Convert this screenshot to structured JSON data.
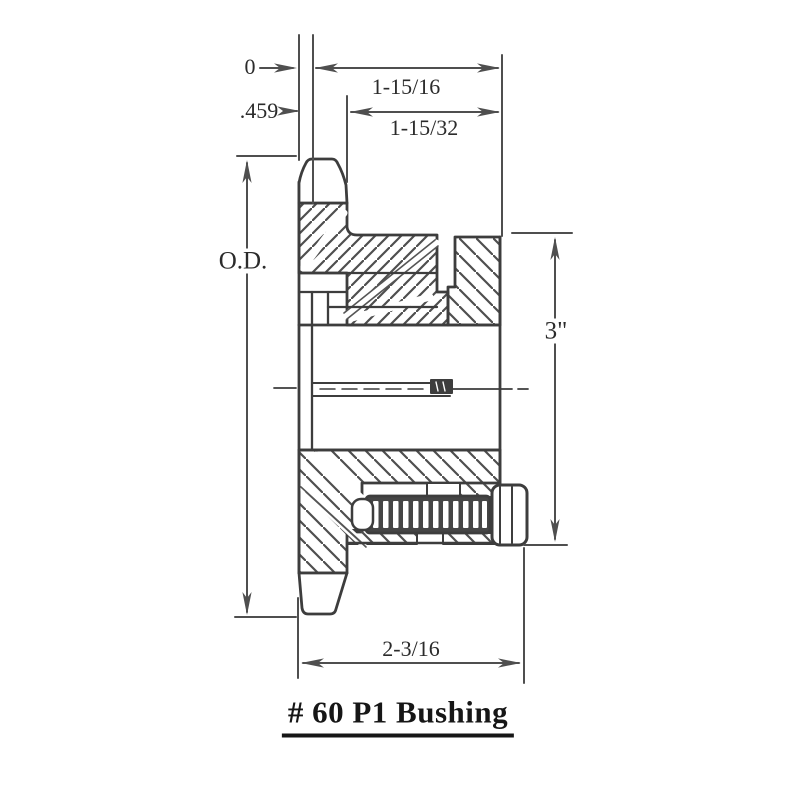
{
  "drawing": {
    "title": "# 60 P1 Bushing",
    "dimensions": {
      "datum_zero": "0",
      "tooth_width": ".459",
      "overall_bushing_length": "1-15/16",
      "hub_length": "1-15/32",
      "outside_diameter_label": "O.D.",
      "flange_diameter": "3\"",
      "overall_width": "2-3/16"
    },
    "colors": {
      "line": "#3d3d3d",
      "dimension_line": "#4f4f4f",
      "text": "#2b2b2b",
      "background": "#ffffff"
    }
  }
}
